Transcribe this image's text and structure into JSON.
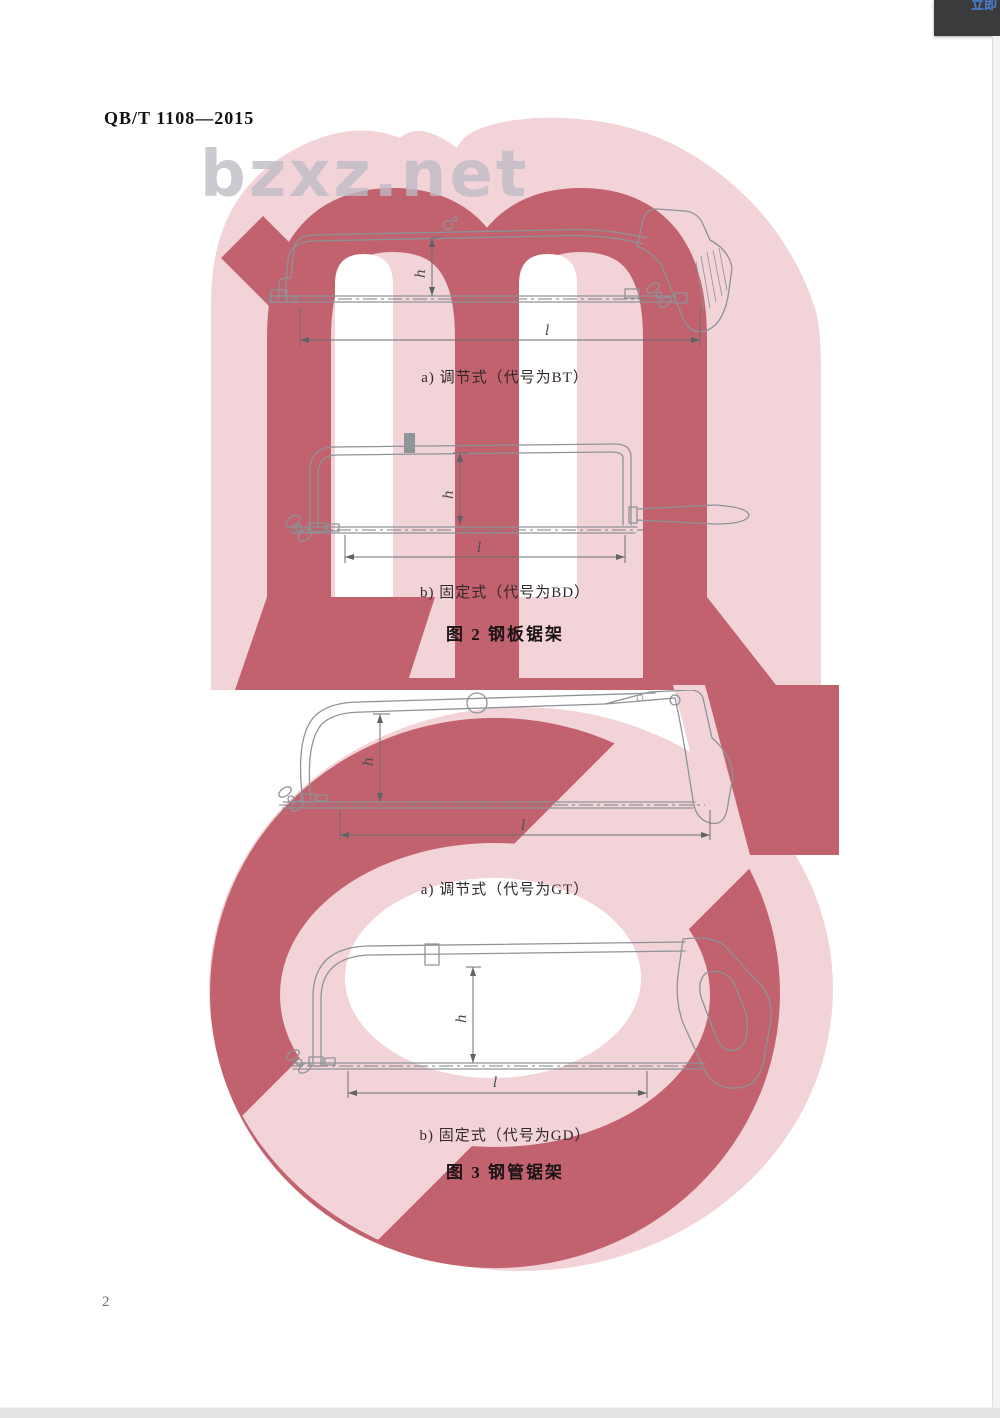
{
  "page": {
    "standard_code": "QB/T 1108—2015",
    "page_number": "2",
    "watermark_text": "bzxz.net",
    "corner_button_text": "立即",
    "colors": {
      "watermark_dark": "#c2626e",
      "watermark_light": "#f1d3d8",
      "corner_box": "#3b3b3d",
      "corner_text": "#4a7fd6",
      "drawing_line": "#8e9398"
    }
  },
  "figure2": {
    "caption_a": "a) 调节式（代号为BT）",
    "caption_b": "b) 固定式（代号为BD）",
    "title": "图 2  钢板锯架"
  },
  "figure3": {
    "caption_a": "a) 调节式（代号为GT）",
    "caption_b": "b) 固定式（代号为GD）",
    "title": "图 3  钢管锯架"
  },
  "dimensions": {
    "height_label": "h",
    "length_label": "l"
  }
}
